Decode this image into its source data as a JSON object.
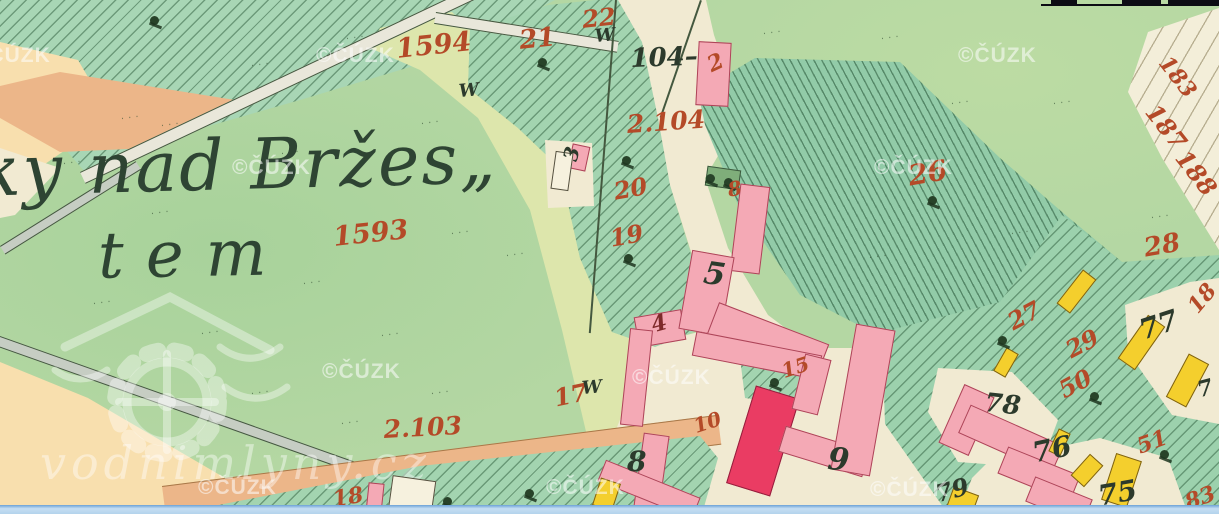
{
  "map": {
    "place_name": {
      "line1": "ky nad Bržes„",
      "line2": "tem"
    },
    "watermarks": {
      "cuzk_text": "©ČÚZK",
      "cuzk_positions": [
        [
          -28,
          44
        ],
        [
          316,
          44
        ],
        [
          958,
          44
        ],
        [
          232,
          156
        ],
        [
          874,
          156
        ],
        [
          322,
          360
        ],
        [
          632,
          366
        ],
        [
          198,
          476
        ],
        [
          546,
          476
        ],
        [
          870,
          478
        ]
      ],
      "site_text": "vodnimlyny.cz"
    },
    "labels": {
      "red_color": "#b44a28",
      "black_color": "#2c3a2c",
      "red": [
        {
          "t": "1594",
          "x": 395,
          "y": 36,
          "s": 27,
          "r": -6
        },
        {
          "t": "21",
          "x": 518,
          "y": 28,
          "s": 26,
          "r": -6
        },
        {
          "t": "22",
          "x": 581,
          "y": 8,
          "s": 24,
          "r": -6
        },
        {
          "t": "2",
          "x": 704,
          "y": 56,
          "s": 22,
          "r": -25
        },
        {
          "t": "2.104",
          "x": 626,
          "y": 112,
          "s": 25,
          "r": -4
        },
        {
          "t": "20",
          "x": 612,
          "y": 180,
          "s": 24,
          "r": -10
        },
        {
          "t": "19",
          "x": 608,
          "y": 227,
          "s": 24,
          "r": -10
        },
        {
          "t": "1593",
          "x": 332,
          "y": 224,
          "s": 27,
          "r": -6
        },
        {
          "t": "2.103",
          "x": 383,
          "y": 417,
          "s": 25,
          "r": -3
        },
        {
          "t": "17",
          "x": 552,
          "y": 387,
          "s": 24,
          "r": -12
        },
        {
          "t": "18",
          "x": 331,
          "y": 489,
          "s": 22,
          "r": -10
        },
        {
          "t": "15",
          "x": 779,
          "y": 362,
          "s": 20,
          "r": -18
        },
        {
          "t": "10",
          "x": 691,
          "y": 417,
          "s": 20,
          "r": -18
        },
        {
          "t": "26",
          "x": 906,
          "y": 163,
          "s": 28,
          "r": -10
        },
        {
          "t": "27",
          "x": 1004,
          "y": 313,
          "s": 24,
          "r": -28
        },
        {
          "t": "29",
          "x": 1062,
          "y": 341,
          "s": 24,
          "r": -28
        },
        {
          "t": "50",
          "x": 1055,
          "y": 381,
          "s": 24,
          "r": -28
        },
        {
          "t": "51",
          "x": 1134,
          "y": 437,
          "s": 22,
          "r": -20
        },
        {
          "t": "8",
          "x": 726,
          "y": 180,
          "s": 20,
          "r": -10
        },
        {
          "t": "28",
          "x": 1142,
          "y": 236,
          "s": 26,
          "r": -10
        },
        {
          "t": "18",
          "x": 1184,
          "y": 303,
          "s": 22,
          "r": -50
        },
        {
          "t": "183",
          "x": 1172,
          "y": 52,
          "s": 22,
          "r": 52
        },
        {
          "t": "187",
          "x": 1160,
          "y": 100,
          "s": 24,
          "r": 52
        },
        {
          "t": "188",
          "x": 1190,
          "y": 146,
          "s": 24,
          "r": 52
        },
        {
          "t": "83",
          "x": 1182,
          "y": 493,
          "s": 22,
          "r": -20
        },
        {
          "t": "4",
          "x": 649,
          "y": 315,
          "s": 22,
          "r": -15,
          "c": "#7e2a2a"
        }
      ],
      "black": [
        {
          "t": "104–",
          "x": 630,
          "y": 46,
          "s": 26,
          "r": -2
        },
        {
          "t": "5",
          "x": 706,
          "y": 258,
          "s": 31,
          "r": 8
        },
        {
          "t": "8",
          "x": 627,
          "y": 448,
          "s": 28,
          "r": 0
        },
        {
          "t": "9",
          "x": 829,
          "y": 444,
          "s": 31,
          "r": 5
        },
        {
          "t": "78",
          "x": 986,
          "y": 390,
          "s": 26,
          "r": 6
        },
        {
          "t": "77",
          "x": 1136,
          "y": 318,
          "s": 28,
          "r": -18
        },
        {
          "t": "76",
          "x": 1030,
          "y": 440,
          "s": 28,
          "r": -12
        },
        {
          "t": "75",
          "x": 1096,
          "y": 483,
          "s": 28,
          "r": -10
        },
        {
          "t": "79",
          "x": 933,
          "y": 483,
          "s": 24,
          "r": -15
        },
        {
          "t": "7",
          "x": 1195,
          "y": 380,
          "s": 22,
          "r": -15
        },
        {
          "t": "3",
          "x": 560,
          "y": 158,
          "s": 20,
          "r": -75
        }
      ],
      "w_text": "W",
      "w_marks": [
        [
          458,
          83
        ],
        [
          594,
          28
        ],
        [
          581,
          380
        ]
      ]
    },
    "features": {
      "buildings": [
        {
          "x": 697,
          "y": 42,
          "w": 33,
          "h": 64,
          "r": 3,
          "f": "pink"
        },
        {
          "x": 570,
          "y": 145,
          "w": 18,
          "h": 25,
          "r": 12,
          "f": "pink"
        },
        {
          "x": 553,
          "y": 152,
          "w": 18,
          "h": 38,
          "r": 8,
          "f": "white"
        },
        {
          "x": 636,
          "y": 313,
          "w": 48,
          "h": 31,
          "r": -10,
          "f": "pink"
        },
        {
          "x": 706,
          "y": 168,
          "w": 34,
          "h": 20,
          "r": 8,
          "f": "green"
        },
        {
          "x": 735,
          "y": 185,
          "w": 30,
          "h": 88,
          "r": 7,
          "f": "pink"
        },
        {
          "x": 685,
          "y": 253,
          "w": 43,
          "h": 80,
          "r": 10,
          "f": "pink"
        },
        {
          "x": 708,
          "y": 322,
          "w": 118,
          "h": 40,
          "r": 21,
          "f": "pink"
        },
        {
          "x": 625,
          "y": 329,
          "w": 23,
          "h": 97,
          "r": 6,
          "f": "pink"
        },
        {
          "x": 638,
          "y": 434,
          "w": 26,
          "h": 82,
          "r": 8,
          "f": "pink"
        },
        {
          "x": 598,
          "y": 478,
          "w": 102,
          "h": 23,
          "r": 22,
          "f": "pink"
        },
        {
          "x": 693,
          "y": 343,
          "w": 128,
          "h": 25,
          "r": 11,
          "f": "pink"
        },
        {
          "x": 740,
          "y": 390,
          "w": 46,
          "h": 102,
          "r": 17,
          "f": "crimson"
        },
        {
          "x": 780,
          "y": 438,
          "w": 88,
          "h": 27,
          "r": 17,
          "f": "pink"
        },
        {
          "x": 798,
          "y": 356,
          "w": 27,
          "h": 57,
          "r": 14,
          "f": "pink"
        },
        {
          "x": 843,
          "y": 326,
          "w": 40,
          "h": 148,
          "r": 10,
          "f": "pink"
        },
        {
          "x": 950,
          "y": 388,
          "w": 33,
          "h": 64,
          "r": 24,
          "f": "pink"
        },
        {
          "x": 960,
          "y": 424,
          "w": 102,
          "h": 31,
          "r": 24,
          "f": "pink"
        },
        {
          "x": 1000,
          "y": 460,
          "w": 78,
          "h": 29,
          "r": 22,
          "f": "pink"
        },
        {
          "x": 1028,
          "y": 487,
          "w": 62,
          "h": 27,
          "r": 22,
          "f": "pink"
        },
        {
          "x": 367,
          "y": 483,
          "w": 16,
          "h": 31,
          "r": 6,
          "f": "pink"
        },
        {
          "x": 390,
          "y": 478,
          "w": 44,
          "h": 36,
          "r": 8,
          "f": "white"
        },
        {
          "x": 1068,
          "y": 270,
          "w": 17,
          "h": 43,
          "r": 38,
          "f": "yellow"
        },
        {
          "x": 1131,
          "y": 316,
          "w": 21,
          "h": 53,
          "r": 35,
          "f": "yellow"
        },
        {
          "x": 1176,
          "y": 356,
          "w": 23,
          "h": 49,
          "r": 28,
          "f": "yellow"
        },
        {
          "x": 999,
          "y": 349,
          "w": 14,
          "h": 27,
          "r": 30,
          "f": "yellow"
        },
        {
          "x": 1053,
          "y": 430,
          "w": 13,
          "h": 25,
          "r": 25,
          "f": "yellow"
        },
        {
          "x": 1078,
          "y": 456,
          "w": 18,
          "h": 29,
          "r": 42,
          "f": "yellow"
        },
        {
          "x": 1108,
          "y": 456,
          "w": 27,
          "h": 49,
          "r": 18,
          "f": "yellow"
        },
        {
          "x": 948,
          "y": 490,
          "w": 27,
          "h": 29,
          "r": 20,
          "f": "yellow"
        },
        {
          "x": 596,
          "y": 480,
          "w": 21,
          "h": 29,
          "r": 18,
          "f": "yellow"
        }
      ],
      "trees": [
        [
          148,
          16
        ],
        [
          536,
          58
        ],
        [
          620,
          156
        ],
        [
          622,
          254
        ],
        [
          704,
          174
        ],
        [
          722,
          178
        ],
        [
          768,
          378
        ],
        [
          926,
          196
        ],
        [
          996,
          336
        ],
        [
          1088,
          392
        ],
        [
          1158,
          450
        ],
        [
          441,
          497
        ],
        [
          523,
          489
        ]
      ],
      "texture_glyph": "···",
      "texture_marks": [
        [
          120,
          113
        ],
        [
          250,
          60
        ],
        [
          345,
          33
        ],
        [
          150,
          208
        ],
        [
          62,
          158
        ],
        [
          280,
          148
        ],
        [
          420,
          118
        ],
        [
          92,
          298
        ],
        [
          200,
          328
        ],
        [
          302,
          278
        ],
        [
          450,
          228
        ],
        [
          380,
          330
        ],
        [
          250,
          388
        ],
        [
          340,
          418
        ],
        [
          762,
          28
        ],
        [
          950,
          98
        ],
        [
          1052,
          98
        ],
        [
          880,
          33
        ],
        [
          1010,
          228
        ],
        [
          1150,
          212
        ],
        [
          430,
          388
        ],
        [
          868,
          252
        ],
        [
          505,
          250
        ],
        [
          160,
          120
        ]
      ]
    },
    "ui": {
      "scalebar": {
        "baseline": {
          "x": 1041,
          "y": 4,
          "w": 178
        },
        "segments": [
          {
            "x": 1051,
            "w": 26,
            "h": 4
          },
          {
            "x": 1122,
            "w": 39,
            "h": 4
          },
          {
            "x": 1168,
            "w": 51,
            "h": 6
          }
        ]
      }
    },
    "colors": {
      "meadow": "#b4d7a3",
      "garden_hatch": "#a3d4b0",
      "dark_meadow": "#92cba8",
      "cream": "#f1ead2",
      "pale": "#dde6ac",
      "peach": "#f8dfae",
      "orange_road": "#ecb689",
      "grey_road": "#c6cdc3",
      "building_pink": "#f4a9b5",
      "building_crimson": "#ea3c63",
      "building_yellow": "#f4cf2d",
      "scrollbar_blue": "#b3d3ec"
    }
  }
}
